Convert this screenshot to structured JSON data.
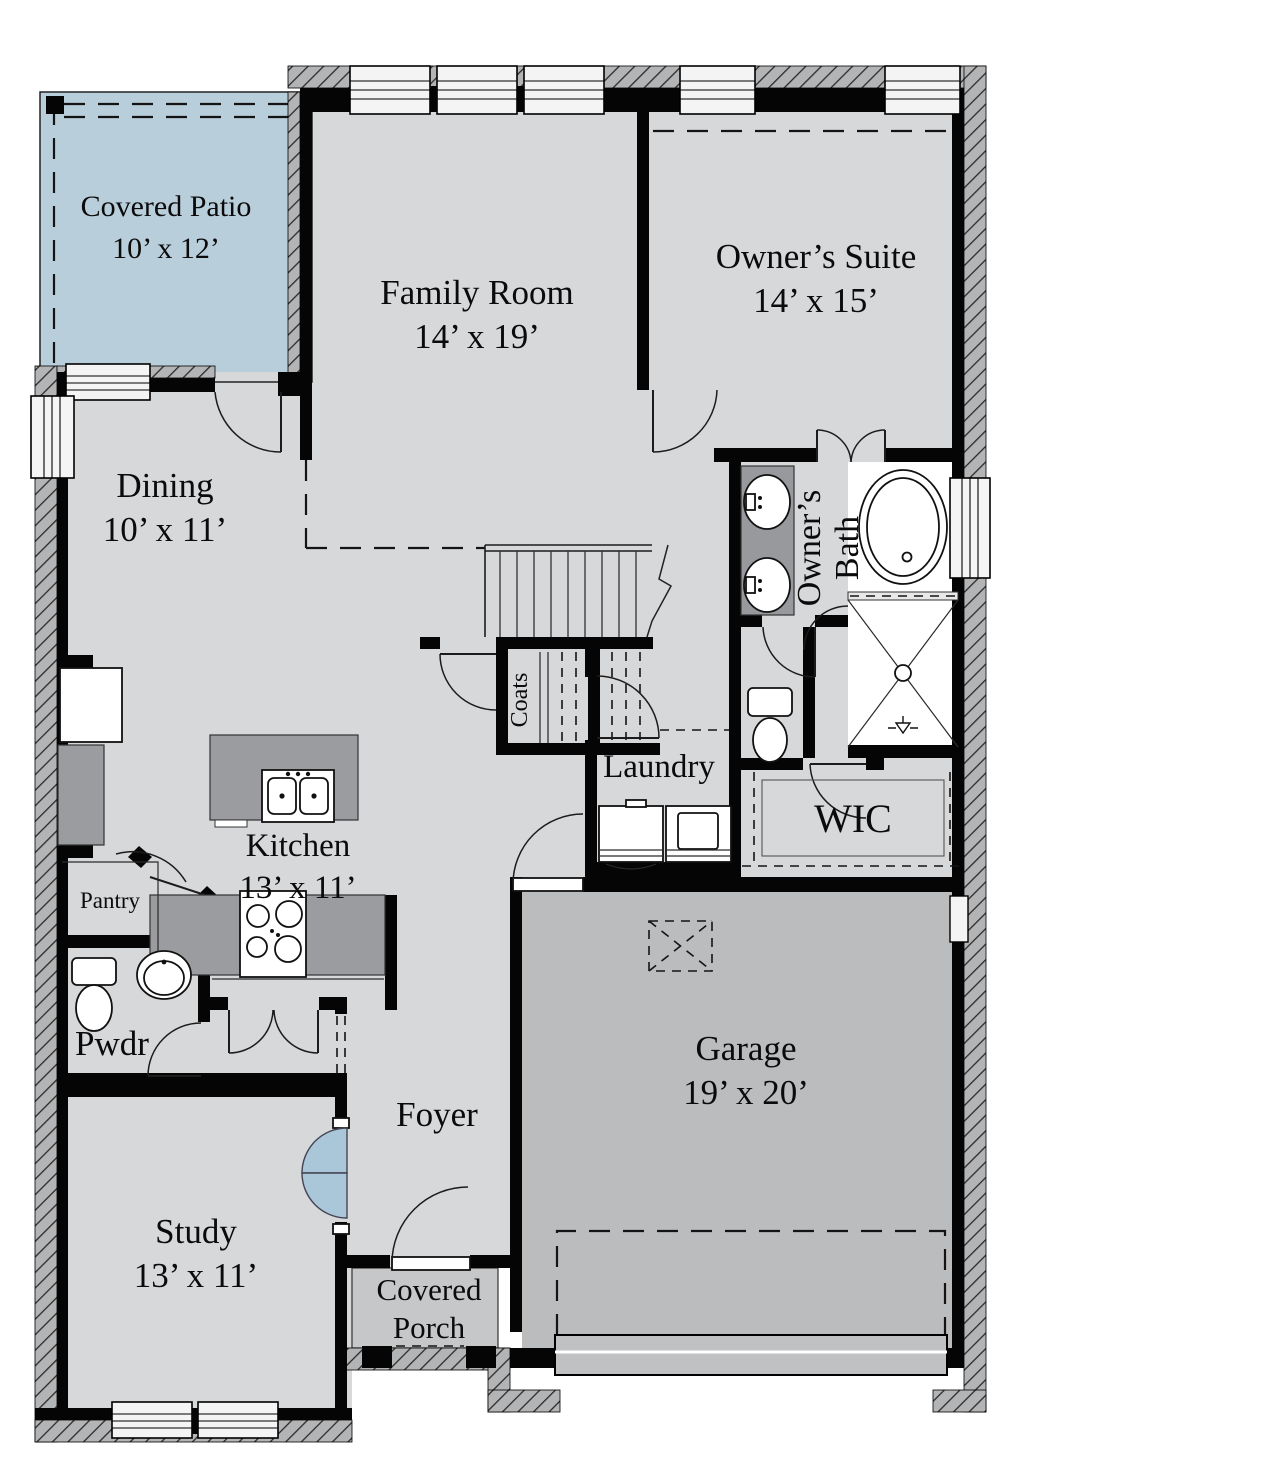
{
  "document_type": "floor-plan",
  "colors": {
    "background": "#ffffff",
    "floor": "#d7d8da",
    "patio_floor": "#b9cedb",
    "garage_floor": "#bbbcbe",
    "porch_floor": "#c6c7c9",
    "wall": "#050505",
    "hatch_base": "#b3b4b6",
    "counter": "#9b9c9f",
    "french_door_blue": "#aac7da"
  },
  "rooms": {
    "covered_patio": {
      "name": "Covered Patio",
      "dims": "10’ x 12’"
    },
    "family_room": {
      "name": "Family Room",
      "dims": "14’ x 19’"
    },
    "owners_suite": {
      "name": "Owner’s Suite",
      "dims": "14’ x 15’"
    },
    "dining": {
      "name": "Dining",
      "dims": "10’ x 11’"
    },
    "owners_bath": {
      "name_line1": "Owner’s",
      "name_line2": "Bath"
    },
    "coats": {
      "name": "Coats"
    },
    "laundry": {
      "name": "Laundry"
    },
    "wic": {
      "name": "WIC"
    },
    "kitchen": {
      "name": "Kitchen",
      "dims": "13’ x 11’"
    },
    "pantry": {
      "name": "Pantry"
    },
    "pwdr": {
      "name": "Pwdr"
    },
    "study": {
      "name": "Study",
      "dims": "13’ x 11’"
    },
    "foyer": {
      "name": "Foyer"
    },
    "covered_porch": {
      "name_line1": "Covered",
      "name_line2": "Porch"
    },
    "garage": {
      "name": "Garage",
      "dims": "19’ x 20’"
    }
  }
}
